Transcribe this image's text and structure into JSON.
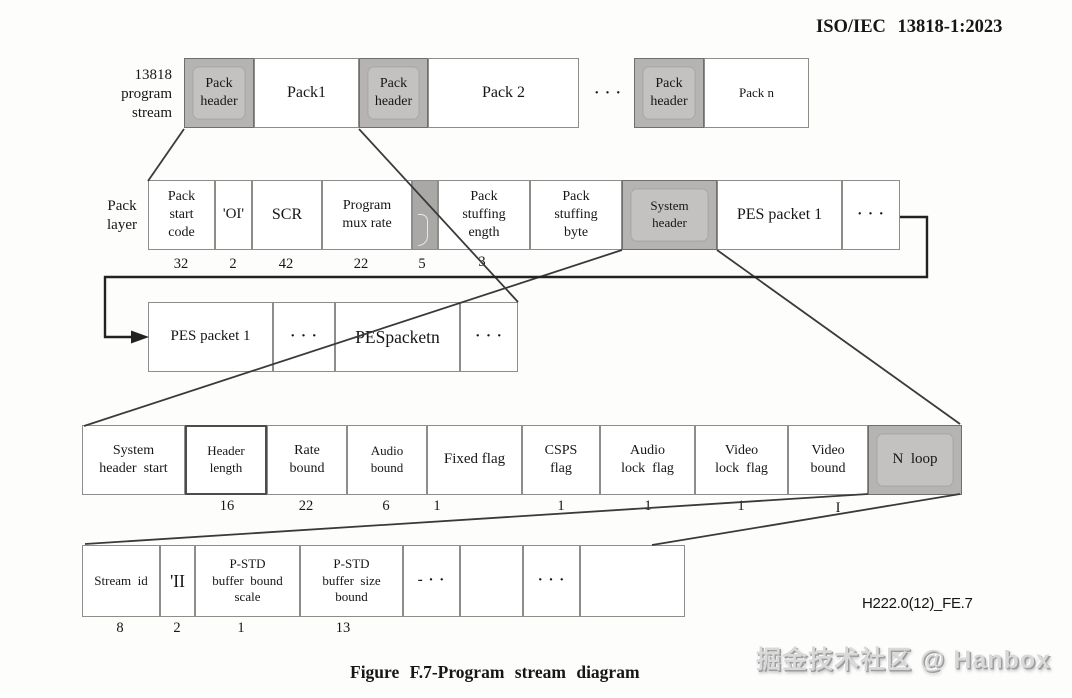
{
  "standard_label": "ISO/IEC 13818-1:2023",
  "caption": "Figure F.7-Program stream diagram",
  "figure_code": "H222.0(12)_FE.7",
  "watermark": "掘金技术社区 @ Hanbox",
  "rows": {
    "program_stream": {
      "side_label": "13818\nprogram\nstream",
      "boxes": [
        "Pack\nheader",
        "Pack1",
        "Pack\nheader",
        "Pack 2",
        "· · ·",
        "Pack\nheader",
        "Pack n"
      ]
    },
    "pack_layer": {
      "side_label": "Pack\nlayer",
      "boxes": [
        "Pack\nstart\ncode",
        "'OI'",
        "SCR",
        "Program\nmux rate",
        "",
        "Pack\nstuffing\nength",
        "Pack\nstuffing\nbyte",
        "System\nheader",
        "PES packet 1",
        "· · ·"
      ],
      "bit_widths": [
        "32",
        "2",
        "42",
        "22",
        "5",
        "3"
      ]
    },
    "pes_layer": {
      "boxes": [
        "PES packet 1",
        "· · ·",
        "PESpacketn",
        "· · ·"
      ]
    },
    "system_header_layer": {
      "boxes": [
        "System\nheader  start",
        "Header\nlength",
        "Rate\nbound",
        "Audio\nbound",
        "Fixed flag",
        "CSPS\nflag",
        "Audio\nlock  flag",
        "Video\nlock  flag",
        "Video\nbound",
        "N  loop"
      ],
      "bit_widths": [
        "16",
        "22",
        "6",
        "1",
        "1",
        "1",
        "1",
        "I"
      ]
    },
    "stream_loop_layer": {
      "boxes": [
        "Stream  id",
        "'II",
        "P-STD\nbuffer  bound\nscale",
        "P-STD\nbuffer  size\nbound",
        "- · ·",
        "",
        "· · ·",
        ""
      ],
      "bit_widths": [
        "8",
        "2",
        "1",
        "13"
      ]
    }
  }
}
